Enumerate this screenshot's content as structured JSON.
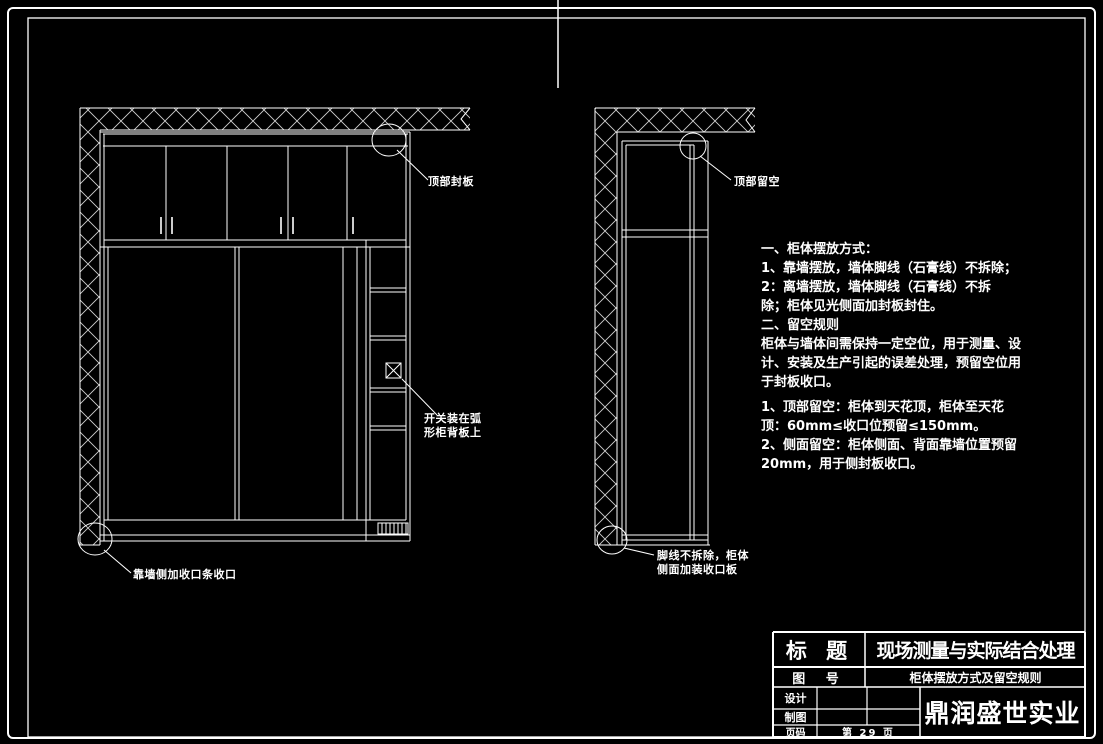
{
  "page": {
    "background": "#000000",
    "line_color": "#ffffff",
    "hatch_color": "#cfcfcf"
  },
  "labels": {
    "top_seal_panel": "顶部封板",
    "switch_note_line1": "开关装在弧",
    "switch_note_line2": "形柜背板上",
    "wall_side_trim": "靠墙侧加收口条收口",
    "top_gap": "顶部留空",
    "skirting_note_line1": "脚线不拆除，柜体",
    "skirting_note_line2": "侧面加装收口板"
  },
  "notes": {
    "lines": [
      "一、柜体摆放方式：",
      "1、靠墙摆放，墙体脚线（石膏线）不拆除；",
      "2：离墙摆放，墙体脚线（石膏线）不拆",
      "除；柜体见光侧面加封板封住。",
      "二、留空规则",
      "柜体与墙体间需保持一定空位，用于测量、设",
      "计、安装及生产引起的误差处理，预留空位用",
      "于封板收口。",
      "1、顶部留空：柜体到天花顶，柜体至天花",
      "顶：60mm≤收口位预留≤150mm。",
      "2、侧面留空：柜体侧面、背面靠墙位置预留",
      "20mm，用于侧封板收口。"
    ]
  },
  "title_block": {
    "title_label": "标 题",
    "title_value": "现场测量与实际结合处理",
    "number_label": "图 号",
    "number_value": "柜体摆放方式及留空规则",
    "design_label": "设计",
    "draft_label": "制图",
    "page_label": "页码",
    "page_value": "第 29 页",
    "company": "鼎润盛世实业"
  }
}
